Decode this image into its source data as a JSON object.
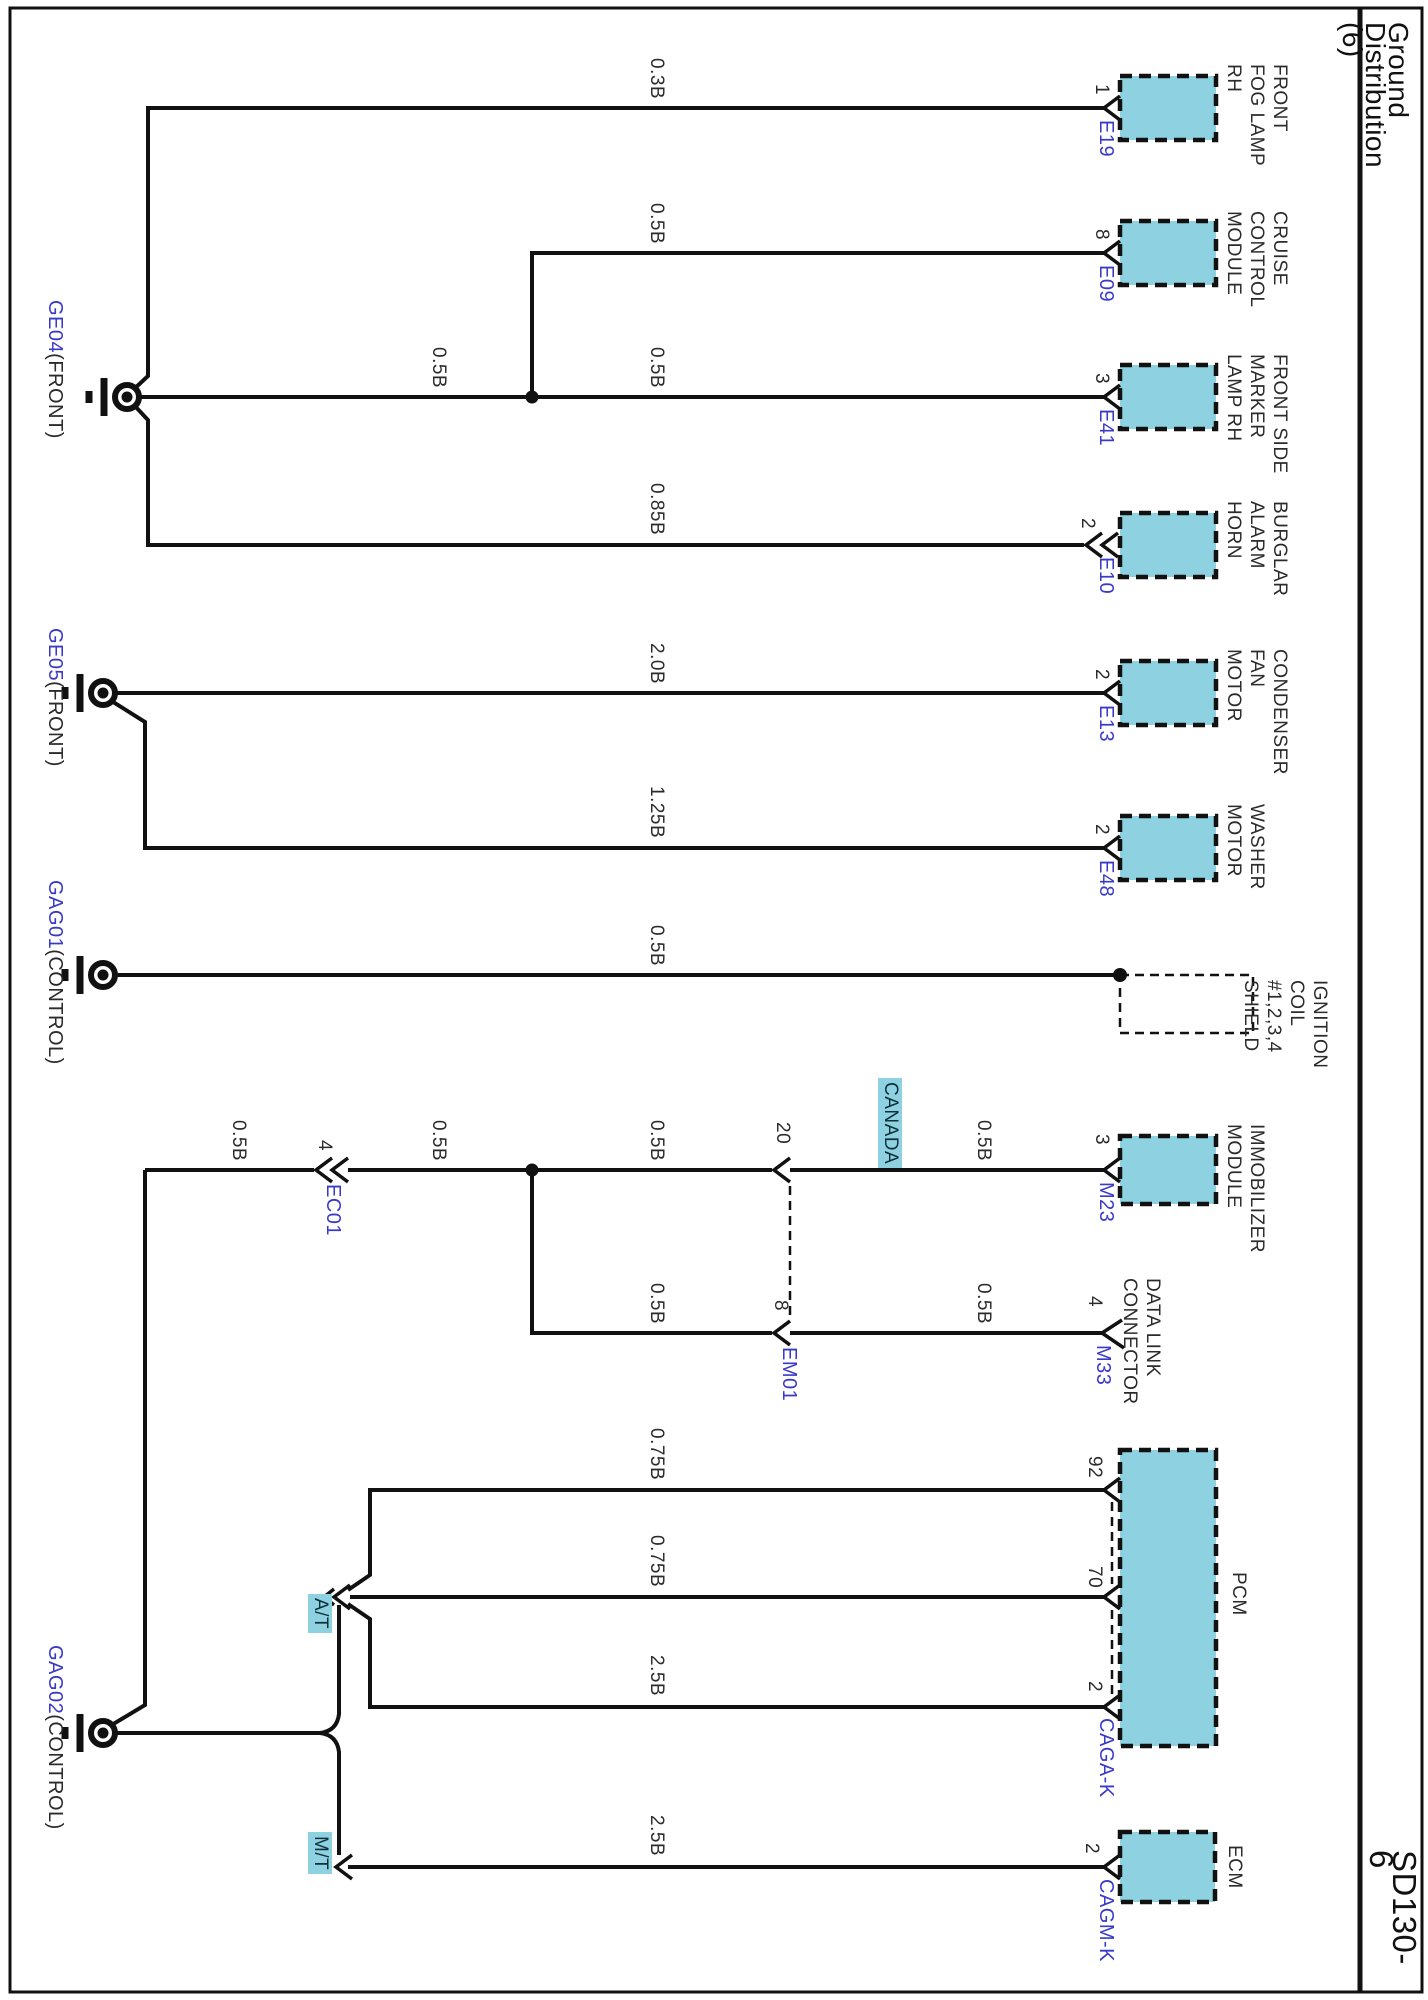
{
  "sheet": {
    "title": "Ground Distribution (6)",
    "code": "SD130-6"
  },
  "colors": {
    "box_fill": "#8ed2e2",
    "highlight": "#8ed2e2",
    "label_blue": "#3a3ac8",
    "wire": "#111111"
  },
  "grounds": [
    {
      "id": "GE04",
      "location": "(FRONT)"
    },
    {
      "id": "GE05",
      "location": "(FRONT)"
    },
    {
      "id": "GAG01",
      "location": "(CONTROL)"
    },
    {
      "id": "GAG02",
      "location": "(CONTROL)"
    }
  ],
  "inline_connectors": [
    {
      "pin": "4",
      "id": "EC01"
    },
    {
      "pin": "20",
      "id": "EM01"
    },
    {
      "pin": "8",
      "id": "EM01"
    }
  ],
  "components": [
    {
      "name": "FRONT\nFOG LAMP\nRH",
      "pin": "1",
      "connector": "E19",
      "wire_size": "0.3B",
      "ground": "GE04"
    },
    {
      "name": "CRUISE\nCONTROL\nMODULE",
      "pin": "8",
      "connector": "E09",
      "wire_size": "0.5B",
      "ground": "GE04"
    },
    {
      "name": "FRONT SIDE\nMARKER\nLAMP RH",
      "pin": "3",
      "connector": "E41",
      "wire_size": "0.5B",
      "trunk_wire_size": "0.5B",
      "ground": "GE04"
    },
    {
      "name": "BURGLAR\nALARM\nHORN",
      "pin": "2",
      "connector": "E10",
      "wire_size": "0.85B",
      "ground": "GE04"
    },
    {
      "name": "CONDENSER\nFAN\nMOTOR",
      "pin": "2",
      "connector": "E13",
      "wire_size": "2.0B",
      "ground": "GE05"
    },
    {
      "name": "WASHER\nMOTOR",
      "pin": "2",
      "connector": "E48",
      "wire_size": "1.25B",
      "ground": "GE05"
    },
    {
      "name": "IGNITION\nCOIL #1,2,3,4\nSHIELD",
      "wire_size": "0.5B",
      "ground": "GAG01"
    },
    {
      "name": "IMMOBILIZER\nMODULE",
      "pin": "3",
      "connector": "M23",
      "segment_wires": [
        "0.5B",
        "0.5B",
        "0.5B",
        "0.5B"
      ],
      "region_tag": "CANADA",
      "ground": "GAG02"
    },
    {
      "name": "DATA LINK\nCONNECTOR",
      "pin": "4",
      "connector": "M33",
      "segment_wires": [
        "0.5B",
        "0.5B"
      ],
      "ground": "GAG02"
    },
    {
      "name": "PCM",
      "connector": "CAGA-K",
      "pins": [
        "92",
        "70",
        "2"
      ],
      "wires": [
        "0.75B",
        "0.75B",
        "2.5B"
      ],
      "transmission_tag": "A/T",
      "ground": "GAG02"
    },
    {
      "name": "ECM",
      "connector": "CAGM-K",
      "pin": "2",
      "wire_size": "2.5B",
      "transmission_tag": "M/T",
      "ground": "GAG02"
    }
  ]
}
